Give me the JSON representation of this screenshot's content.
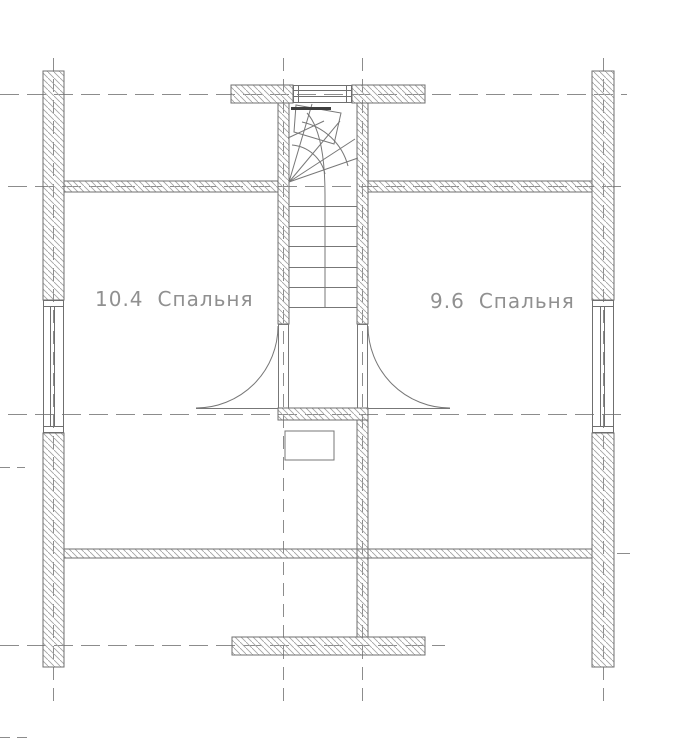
{
  "colors": {
    "background": "#ffffff",
    "wall_outline": "#6f6f6f",
    "wall_hatch": "#a3a3a3",
    "stair_line": "#777777",
    "axis_line": "#8c8c8c",
    "label_text": "#909090",
    "landing_edge": "#3f3f3f"
  },
  "floor_plan": {
    "rooms": [
      {
        "area": "10.4",
        "name": "Спальня"
      },
      {
        "area": "9.6",
        "name": "Спальня"
      }
    ]
  }
}
